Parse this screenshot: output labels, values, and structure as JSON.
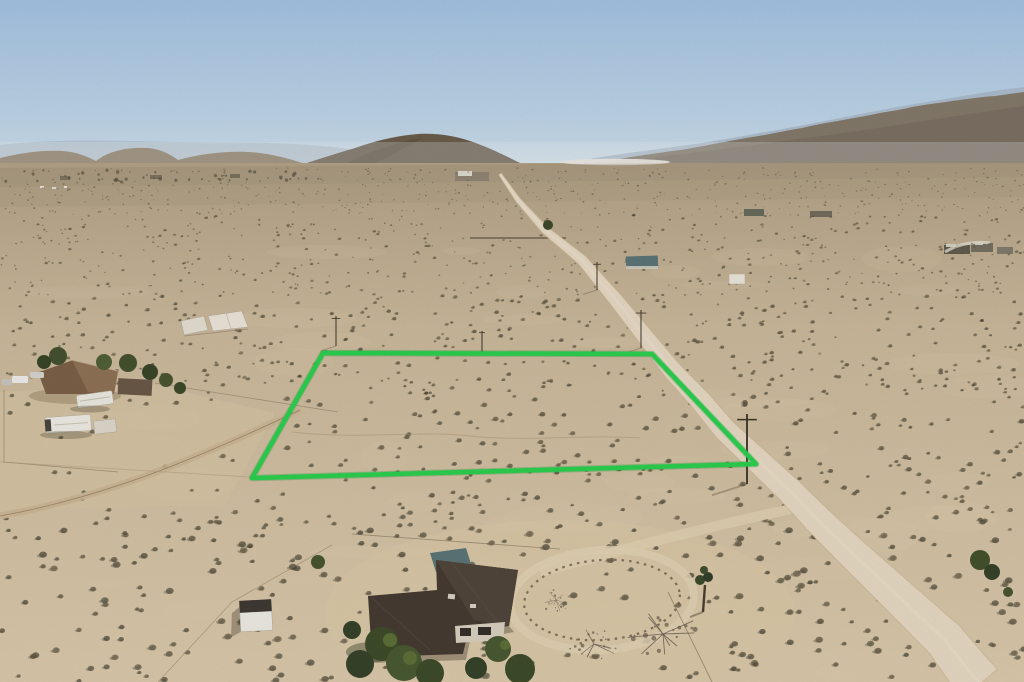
{
  "meta": {
    "kind": "aerial-drone-photograph",
    "subject": "desert land parcel with green property-boundary overlay",
    "width": 1024,
    "height": 682
  },
  "colors": {
    "sky_top": "#a4c4e4",
    "sky_mid": "#c3d8e9",
    "sky_horizon": "#e4edf2",
    "mountain_far": "#b4c1ce",
    "mountain_back_right": "#a9b8c7",
    "mountain_front_right": "#857a6b",
    "hill_center": "#6b5e4c",
    "hills_left": "#8f7d65",
    "ground_far": "#b3a287",
    "ground_mid": "#ccba9c",
    "ground_near": "#dccaac",
    "shrub_dark": "#55503d",
    "road": "#e8dac4",
    "road_edge": "#c9b492",
    "boundary_green": "#2bd14f",
    "roof_dark": "#463c33",
    "roof_teal": "#5d7678",
    "rv_white": "#eceae3",
    "tree_green": "#44522e"
  },
  "boundary": {
    "label": "parcel-outline",
    "points": "323,353 652,354 756,464 252,478",
    "stroke_width": 4.5
  },
  "road": {
    "centerline": [
      [
        174,
        500
      ],
      [
        200,
        518
      ],
      [
        230,
        545
      ],
      [
        260,
        582
      ],
      [
        300,
        616
      ],
      [
        330,
        640
      ],
      [
        370,
        672
      ],
      [
        400,
        700
      ],
      [
        430,
        725
      ],
      [
        460,
        757
      ],
      [
        490,
        789
      ],
      [
        520,
        818
      ],
      [
        550,
        849
      ],
      [
        580,
        881
      ],
      [
        610,
        913
      ],
      [
        640,
        945
      ],
      [
        670,
        968
      ],
      [
        684,
        980
      ]
    ],
    "widths": [
      [
        174,
        3
      ],
      [
        230,
        8
      ],
      [
        300,
        14
      ],
      [
        400,
        21
      ],
      [
        500,
        27
      ],
      [
        600,
        36
      ],
      [
        684,
        46
      ]
    ]
  },
  "visible_features": [
    "desert valley floor with scattered shrubs",
    "hazy mountain ranges on horizon",
    "dark hill at center horizon",
    "diagonal dirt road with utility poles",
    "green outlined vacant parcel",
    "homestead with RV trailers at left",
    "house with dark roof at bottom center",
    "circular rock-lined driveway",
    "joshua tree and bare trees",
    "small sheds and distant structures"
  ]
}
